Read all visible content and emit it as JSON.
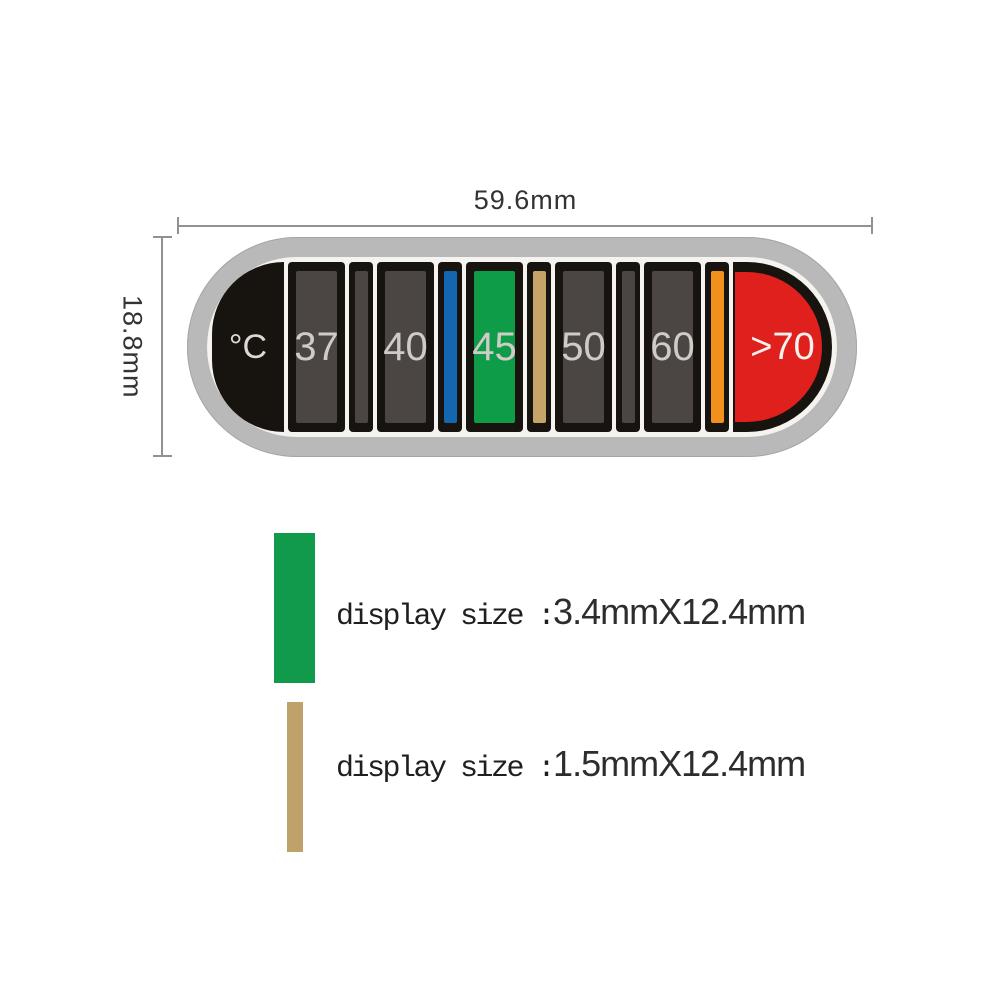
{
  "dimensions": {
    "width_label": "59.6mm",
    "height_label": "18.8mm"
  },
  "strip": {
    "colors": {
      "shell": "#b9b9b9",
      "face": "#f5f3ef",
      "frame": "#17130f",
      "cell_dark": "#4b4643",
      "blue": "#1466b0",
      "green": "#0f9c49",
      "tan": "#c6a368",
      "orange": "#f28f1d",
      "red": "#e0201c"
    },
    "cells": [
      {
        "kind": "cap-left",
        "label": "°C"
      },
      {
        "kind": "wide",
        "label": "37",
        "fill": "cell_dark"
      },
      {
        "kind": "narrow",
        "fill": "cell_dark"
      },
      {
        "kind": "wide",
        "label": "40",
        "fill": "cell_dark"
      },
      {
        "kind": "narrow",
        "fill": "blue"
      },
      {
        "kind": "wide",
        "label": "45",
        "fill": "green"
      },
      {
        "kind": "narrow",
        "fill": "tan"
      },
      {
        "kind": "wide",
        "label": "50",
        "fill": "cell_dark"
      },
      {
        "kind": "narrow",
        "fill": "cell_dark"
      },
      {
        "kind": "wide",
        "label": "60",
        "fill": "cell_dark"
      },
      {
        "kind": "narrow",
        "fill": "orange"
      },
      {
        "kind": "cap-right",
        "label": ">70",
        "fill": "red"
      }
    ]
  },
  "legend": [
    {
      "swatch": "wide",
      "swatch_color": "#119a4b",
      "prefix": "display size :",
      "value": "3.4mmX12.4mm"
    },
    {
      "swatch": "narrow",
      "swatch_color": "#bfa26a",
      "prefix": "display size :",
      "value": "1.5mmX12.4mm"
    }
  ]
}
